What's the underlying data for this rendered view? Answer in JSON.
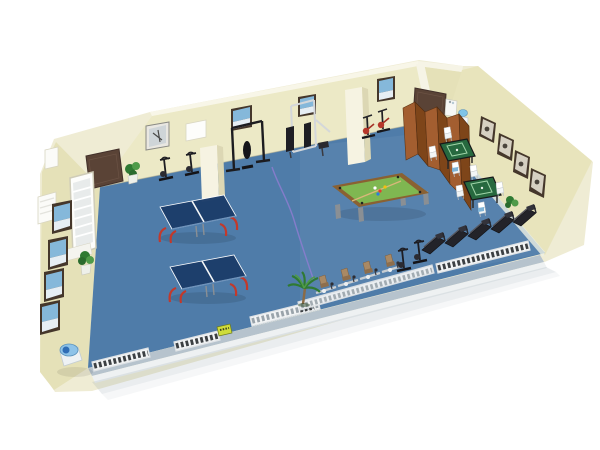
{
  "meta": {
    "type": "3d-room-render",
    "description": "3D perspective rendering of a recreation and fitness room with cream walls and a blue floor; no visible text in the image",
    "zones": [
      "table-tennis-area",
      "billiards-area",
      "mahjong-corner",
      "cardio-row",
      "strength-area"
    ]
  },
  "palette": {
    "background": "#ffffff",
    "silhouette": "#efecd4",
    "wall": "#ece9c6",
    "wall_shaded": "#e5e1b8",
    "wall_east": "#e8e4bc",
    "wall_rim": "#f8f6e8",
    "floor": "#4f7ca9",
    "skirting_shadow": "#b6c3cd",
    "skirting_white": "#eef1f2",
    "table_tennis_top": "#1d3e6b",
    "table_tennis_leg": "#c2392b",
    "billiard_felt": "#7fb751",
    "billiard_wood": "#8a6132",
    "mahjong_top": "#27693f",
    "partition_light": "#a35e30",
    "partition_dark": "#7e4519",
    "door": "#5a4336",
    "equipment_dark": "#232329",
    "metal": "#c8ced3",
    "seat_tan": "#a98964",
    "radiator_frame": "#f2f4f5",
    "radiator_slat": "#3c4043",
    "plant_dark": "#2f7a33",
    "plant_light": "#4f9b49",
    "cable": "#8d7cd0",
    "water_blue": "#7fc4e8",
    "picture_sky": "#85b8da",
    "picture_pale": "#e6eef4",
    "picture_gray": "#d6d0c2",
    "frame_dark": "#45372b"
  },
  "inventory": {
    "table_tennis_tables": 2,
    "billiard_tables": 1,
    "mahjong_tables": 2,
    "mahjong_chairs": 7,
    "treadmills": 5,
    "recumbent_bikes": 4,
    "upright_bikes": 2,
    "spin_bikes": 2,
    "elliptical_trainers": 2,
    "strength_stations": 2,
    "partition_panels": 6,
    "doors": 2,
    "columns": 2,
    "windows": 1,
    "exterior_window_panels": 2,
    "wall_pictures_back": 4,
    "wall_pictures_left": 4,
    "wall_pictures_right": 4,
    "whiteboards": 1,
    "plants": 4,
    "radiator_segments": 5,
    "water_dispensers": 1,
    "cabinets": 1,
    "drinking_fountains": 1,
    "floor_cables": 1,
    "small_yellow_boxes": 1
  }
}
